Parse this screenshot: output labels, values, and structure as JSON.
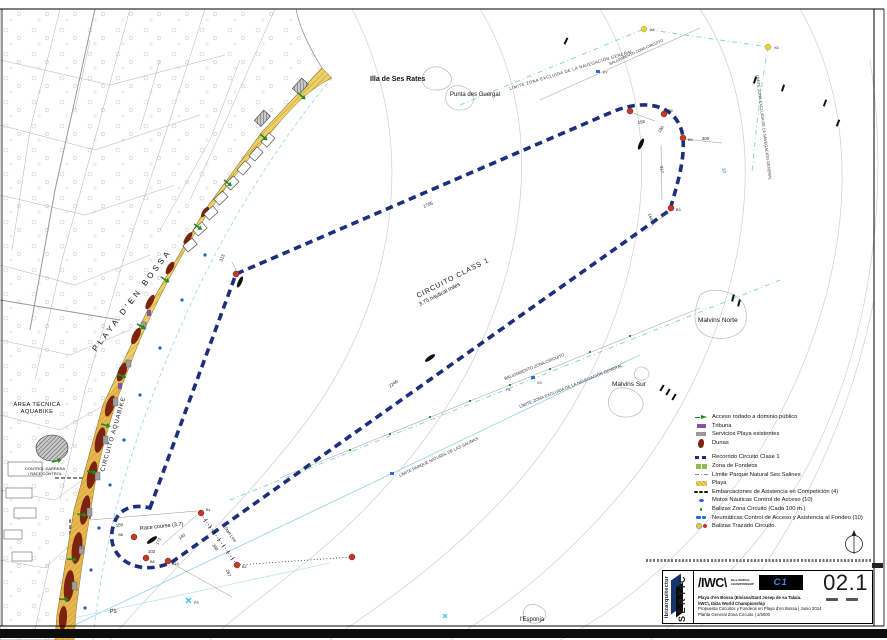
{
  "sheet": {
    "number": "02.1",
    "firm": "SERTIC",
    "brand": "ibizarquitectur",
    "iwc_logo": "/IWC\\",
    "iwc_sub1": "Ibiza",
    "iwc_sub2": "WORLD",
    "iwc_sub3": "CHAMPIONSHIP",
    "c1_logo": "C1",
    "title_lines": [
      "Playa d'en Bossa (Eivissa/Sant Josep de sa Talaia.",
      "/IWC\\, Ibiza World Championship",
      "Propuesta Circuitos y Fondeos en Playa d'en Bossa | Junio 2014",
      "Planta General Zona Circuito | 1/5000"
    ]
  },
  "legend": {
    "items": [
      {
        "label": "Acceso rodado a dominio público"
      },
      {
        "label": "Tribuna"
      },
      {
        "label": "Servicios Playa existentes"
      },
      {
        "label": "Dunas"
      },
      {
        "label": "Recorrido Circuito Clase 1"
      },
      {
        "label": "Zona de Fondeos"
      },
      {
        "label": "Límite Parque Natural Ses Salines"
      },
      {
        "label": "Playa"
      },
      {
        "label": "Embarcaciones de Asistencia en Competición (4)"
      },
      {
        "label": "Motos Náuticas Control de Acceso (10)"
      },
      {
        "label": "Balizas Zona Circuito (Cada 100 m.)"
      },
      {
        "label": "Neumáticas Control de Acceso y Asistencia al Fondeo (10)"
      },
      {
        "label": "Balizas Trazado Circuito."
      }
    ]
  },
  "labels": {
    "island": "Illa de Ses Rates",
    "punta": "Punta des Guergal",
    "malvins_norte": "Malvins Norte",
    "malvins_sur": "Malvins Sur",
    "esponja": "l'Esponja",
    "ps": "PS",
    "playa_bossa": "PLAYA D'EN BOSSA",
    "circuito_aquabike": "CIRCUITO AQUABIKE",
    "area_tecnica_1": "ÁREA TÉCNICA",
    "area_tecnica_2": "AQUABIKE",
    "control_1": "CONTROL CARRERA",
    "control_2": "/ RACE CONTROL",
    "circuit_name": "CIRCUITO CLASS 1",
    "circuit_dist": "3.75 nautical miles",
    "race_course": "Race course (3.7)",
    "start_line": "Start Line"
  },
  "boundaries": {
    "limite_nav": "LÍMITE ZONA EXCLUIDA DE LA NAVEGACIÓN GENERAL",
    "balizamiento": "BALIZAMIENTO ZONA CIRCUITO",
    "limite_parque": "LÍMITE PARQUE NATURAL DE LAS SALINAS"
  },
  "dimensions": {
    "d1705": "1705",
    "d313": "313",
    "d2246": "2246",
    "d158": "158",
    "d190": "190",
    "d200": "200",
    "d317": "317",
    "d164": "164",
    "d172": "172",
    "d102": "102",
    "d240": "240",
    "d300": "300",
    "d267": "267",
    "d189": "189"
  },
  "buoys": {
    "b1": "B1",
    "b2": "B2",
    "b3": "B3",
    "b4": "B4",
    "b5": "B5",
    "b6": "B6",
    "b8": "B8",
    "b10": "B10"
  },
  "markers": {
    "x3": "X3",
    "x4": "X4",
    "x5": "X5",
    "p1": "P1",
    "p3": "P3",
    "p4": "P4",
    "p7": "P7"
  },
  "depth": {
    "d10": "10"
  },
  "colors": {
    "circuit": "#1b2f7a",
    "buoy_red": "#c0392b",
    "beach": "#eed069",
    "limit_cyan": "#8fd0e4",
    "access_green": "#1e8c1e",
    "marker_blue": "#2a6fd4",
    "marker_yellow": "#e8d42a"
  }
}
